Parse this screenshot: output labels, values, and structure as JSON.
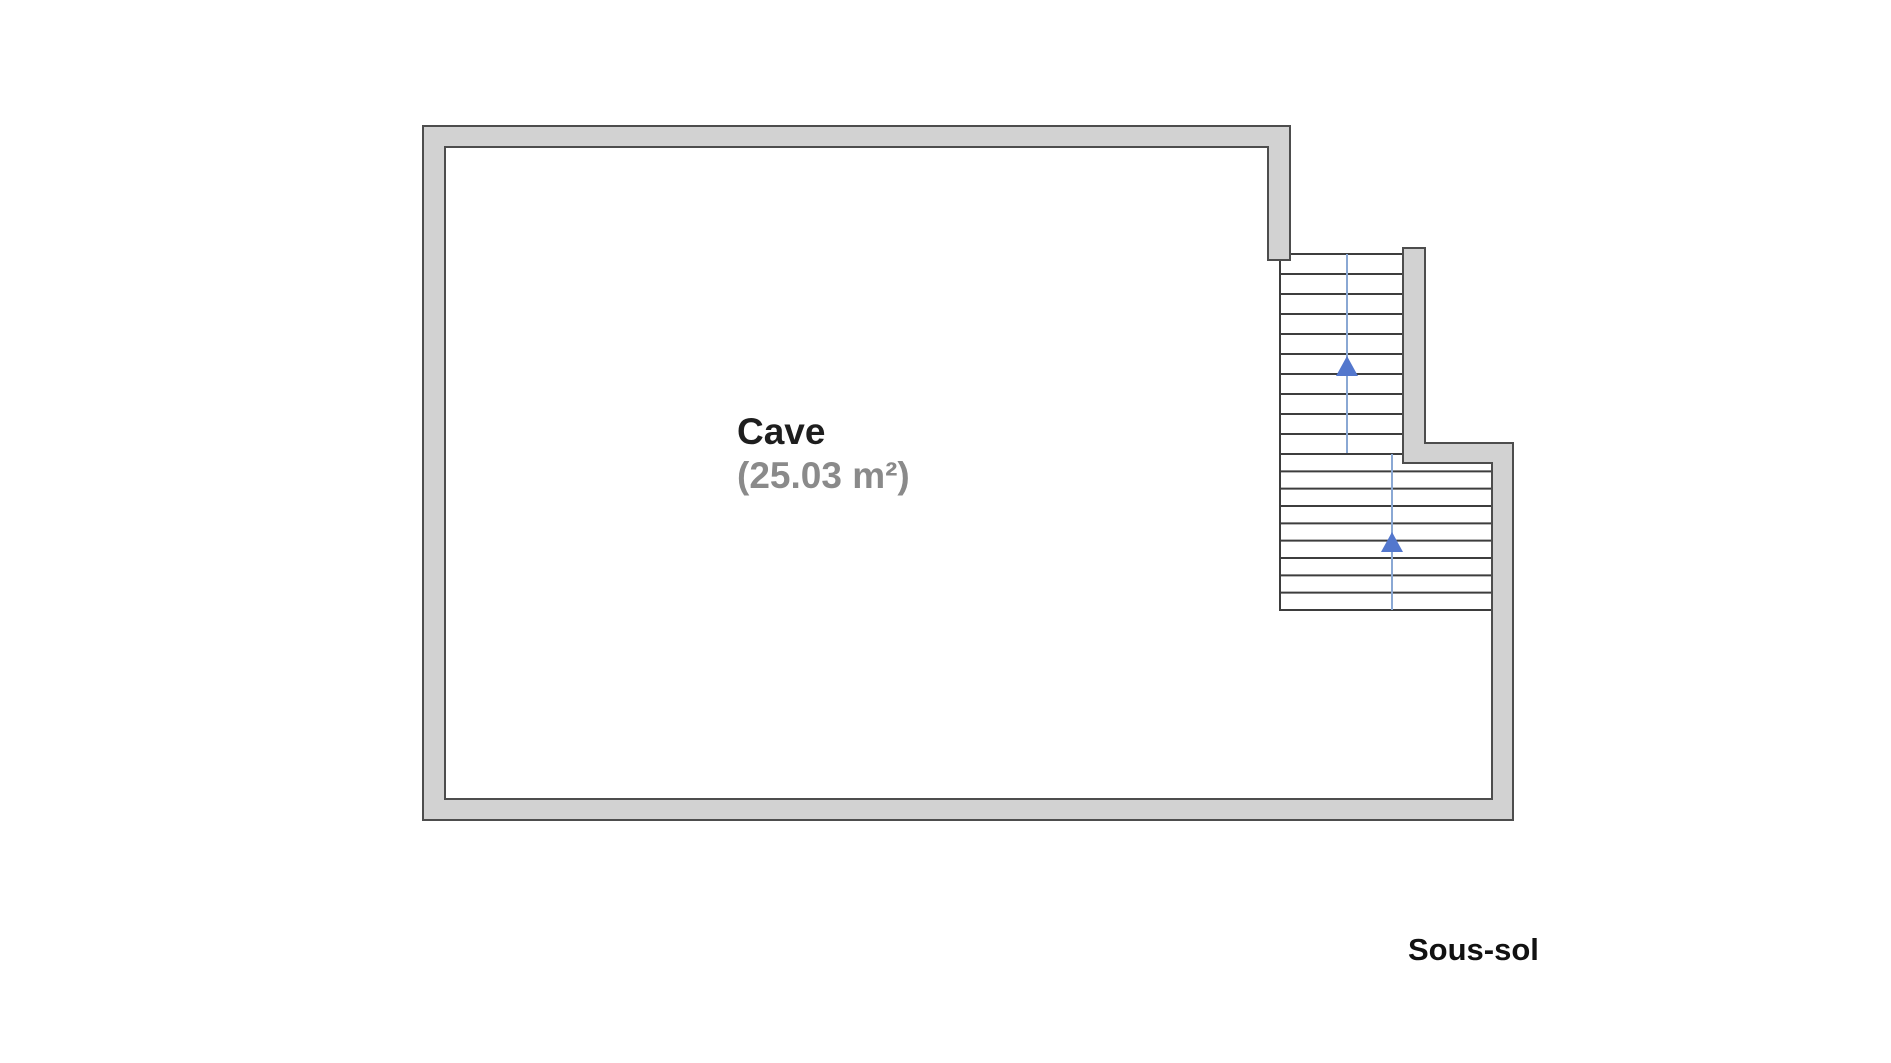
{
  "page": {
    "background": "#ffffff"
  },
  "floor_plan": {
    "room": {
      "name": "Cave",
      "area": "(25.03 m²)"
    },
    "floor_label": "Sous-sol",
    "stairs": {
      "upper_flight": {
        "treads": 10,
        "direction": "up"
      },
      "lower_flight": {
        "treads": 9,
        "direction": "up"
      }
    }
  },
  "colors": {
    "wall-fill": "#d2d2d2",
    "wall-outline": "#4d4d4d",
    "stair-outline": "#3d3d3d",
    "guide-line-color": "#8aa8d4",
    "arrow-color": "#5377cd",
    "room-name-color": "#1e1e1e",
    "room-area-color": "#8a8a8a",
    "floor-label-color": "#111111"
  }
}
